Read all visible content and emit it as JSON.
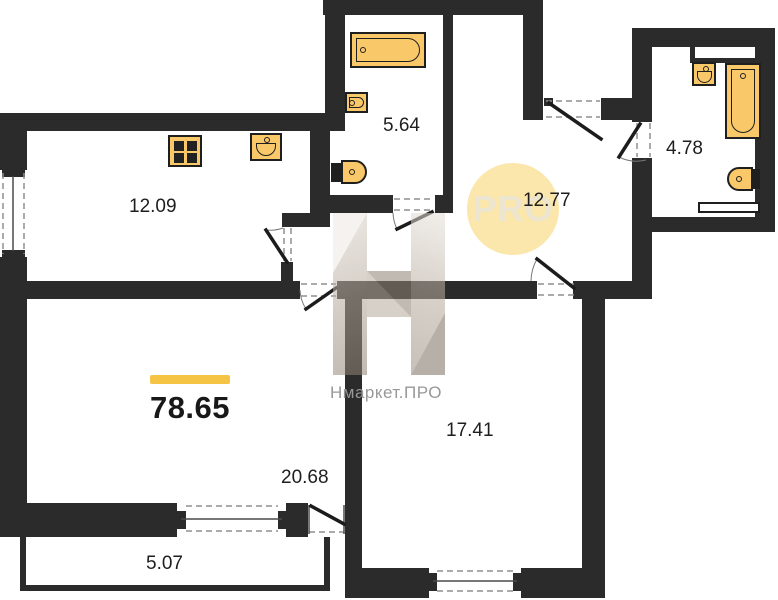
{
  "plan": {
    "total_area_label": "78.65",
    "rooms": {
      "kitchen": {
        "area": "12.09"
      },
      "bathroom_small": {
        "area": "5.64"
      },
      "bathroom_large": {
        "area": "4.78"
      },
      "hall": {
        "area": "12.77"
      },
      "living": {
        "area": "20.68"
      },
      "bedroom": {
        "area": "17.41"
      },
      "balcony": {
        "area": "5.07"
      }
    },
    "watermark": {
      "circle_text": "PRO",
      "brand_text": "Нмаркет.ПРО"
    },
    "fixtures": {
      "kitchen": [
        "stove-icon",
        "kitchen-sink-icon"
      ],
      "bathroom_small": [
        "bathtub-icon",
        "washbasin-icon",
        "toilet-icon"
      ],
      "bathroom_large": [
        "washbasin-icon",
        "bathtub-icon",
        "toilet-icon"
      ]
    },
    "colors": {
      "wall": "#2b2b2b",
      "fixture_fill": "#f9c868",
      "accent_bar": "#f6c445",
      "watermark_circle": "#fbe6ab",
      "watermark_text": "#ece5d0",
      "brand_text": "#989898"
    }
  }
}
